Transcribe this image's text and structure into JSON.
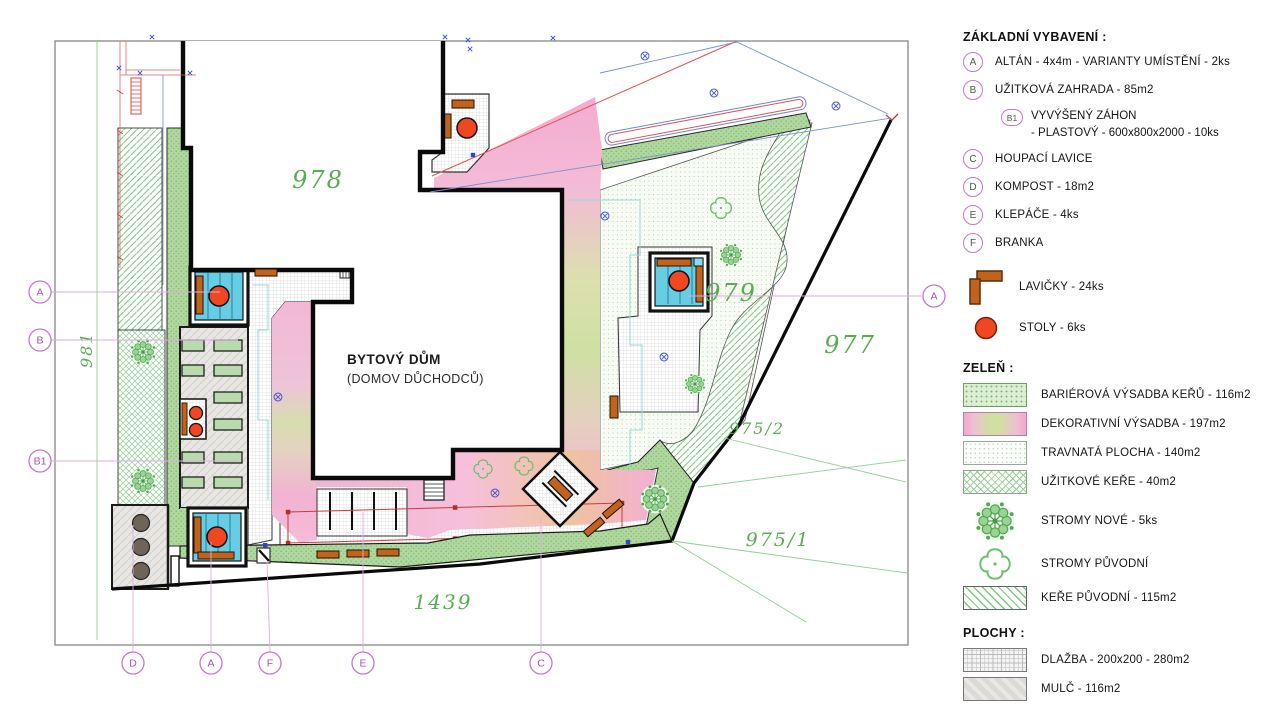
{
  "plan": {
    "building_title": "BYTOVÝ DŮM",
    "building_subtitle": "(DOMOV DŮCHODCŮ)",
    "parcels": {
      "p978": "978",
      "p979": "979",
      "p977": "977",
      "p975_2": "975/2",
      "p975_1": "975/1",
      "p1439": "1439",
      "p981": "981"
    },
    "markers": {
      "a": "A",
      "b": "B",
      "b1": "B1",
      "c": "C",
      "d": "D",
      "e": "E",
      "f": "F"
    },
    "colors": {
      "gazebo_cyan": "#66cde4",
      "table_red": "#ee4722",
      "bench_brown": "#c2631c",
      "marker_purple": "#c478c8",
      "parcel_green": "#58ad52",
      "deco_pink": "#f3b7d6"
    }
  },
  "legend": {
    "equipment_title": "ZÁKLADNÍ VYBAVENÍ :",
    "equipment": [
      {
        "code": "A",
        "text": "ALTÁN - 4x4m - VARIANTY UMÍSTĚNÍ - 2ks"
      },
      {
        "code": "B",
        "text": "UŽITKOVÁ ZAHRADA - 85m2"
      },
      {
        "code": "B1",
        "text": "VYVÝŠENÝ ZÁHON",
        "text2": "- PLASTOVÝ - 600x800x2000 - 10ks"
      },
      {
        "code": "C",
        "text": "HOUPACÍ LAVICE"
      },
      {
        "code": "D",
        "text": "KOMPOST - 18m2"
      },
      {
        "code": "E",
        "text": "KLEPÁČE - 4ks"
      },
      {
        "code": "F",
        "text": "BRANKA"
      }
    ],
    "benches_label": "LAVIČKY - 24ks",
    "tables_label": "STOLY - 6ks",
    "greenery_title": "ZELEŇ :",
    "greenery": [
      {
        "label": "BARIÉROVÁ VÝSADBA KEŘŮ - 116m2"
      },
      {
        "label": "DEKORATIVNÍ VÝSADBA - 197m2"
      },
      {
        "label": "TRAVNATÁ PLOCHA - 140m2"
      },
      {
        "label": "UŽITKOVÉ KEŘE - 40m2"
      },
      {
        "label": "STROMY NOVÉ - 5ks"
      },
      {
        "label": "STROMY PŮVODNÍ"
      },
      {
        "label": "KEŘE PŮVODNÍ - 115m2"
      }
    ],
    "surfaces_title": "PLOCHY :",
    "surfaces": [
      {
        "label": "DLAŽBA - 200x200 - 280m2"
      },
      {
        "label": "MULČ - 116m2"
      }
    ]
  }
}
